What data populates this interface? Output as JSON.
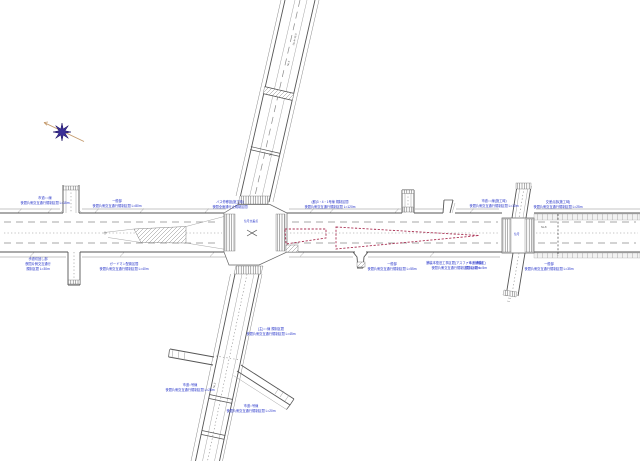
{
  "colors": {
    "bg": "#ffffff",
    "label-blue": "#2230c8",
    "red-dash": "#ab3355",
    "line-dark": "#555555",
    "line-mid": "#8a8a8a",
    "compass-purple": "#3b2f96",
    "compass-tan": "#c49a6c"
  },
  "annotations": {
    "a1": {
      "lines": [
        "市道○○線",
        "夜間片側交互通行規制区間 L=15m"
      ]
    },
    "a2": {
      "lines": [
        "一般部",
        "夜間片側交互通行規制区間 L=80m"
      ]
    },
    "a3": {
      "lines": [
        "歩道切回し部",
        "夜間片側交互通行",
        "規制区間 L=30m"
      ]
    },
    "a4": {
      "lines": [
        "ガードマン配置区間",
        "夜間片側交互通行規制区間 L=40m"
      ]
    },
    "a5": {
      "lines": [
        "バス停移設(施工時)",
        "夜間全面通行止規制区間"
      ]
    },
    "a6": {
      "lines": [
        "(都)3・4・1号線 規制区間",
        "夜間片側交互通行規制区間 L=120m"
      ]
    },
    "a7": {
      "lines": [
        "一般部",
        "夜間片側交互通行規制区間 L=55m"
      ]
    },
    "a8": {
      "lines": [
        "舗装本復旧工事区間(アスファルト舗装工)",
        "夜間片側交互通行規制区間 L=60m"
      ]
    },
    "a9": {
      "lines": [
        "市道○○線(施工時)",
        "夜間片側交互通行規制区間 L=10m"
      ]
    },
    "a10": {
      "lines": [
        "交差点部(施工時)",
        "夜間片側交互通行規制区間 L=25m"
      ]
    },
    "a11": {
      "lines": [
        "市道○号線",
        "規制区間 L=5m"
      ]
    },
    "a12": {
      "lines": [
        "一般部",
        "夜間片側交互通行規制区間 L=35m"
      ]
    },
    "a13": {
      "lines": [
        "(主)○○線 規制区間",
        "夜間片側交互通行規制区間 L=45m"
      ]
    },
    "a14": {
      "lines": [
        "市道○号線",
        "夜間片側交互通行規制区間 L=25m"
      ]
    },
    "a15": {
      "lines": [
        "市道○号線",
        "夜間片側交互通行規制区間 L=20m"
      ]
    }
  },
  "intersections": {
    "center_label": "信号交差点",
    "right_label": "信号"
  },
  "stations": {
    "s1": "No.4+15.0",
    "s2": "No.4",
    "s3": "No.3",
    "s4": "No.8",
    "s6": "No.2"
  }
}
